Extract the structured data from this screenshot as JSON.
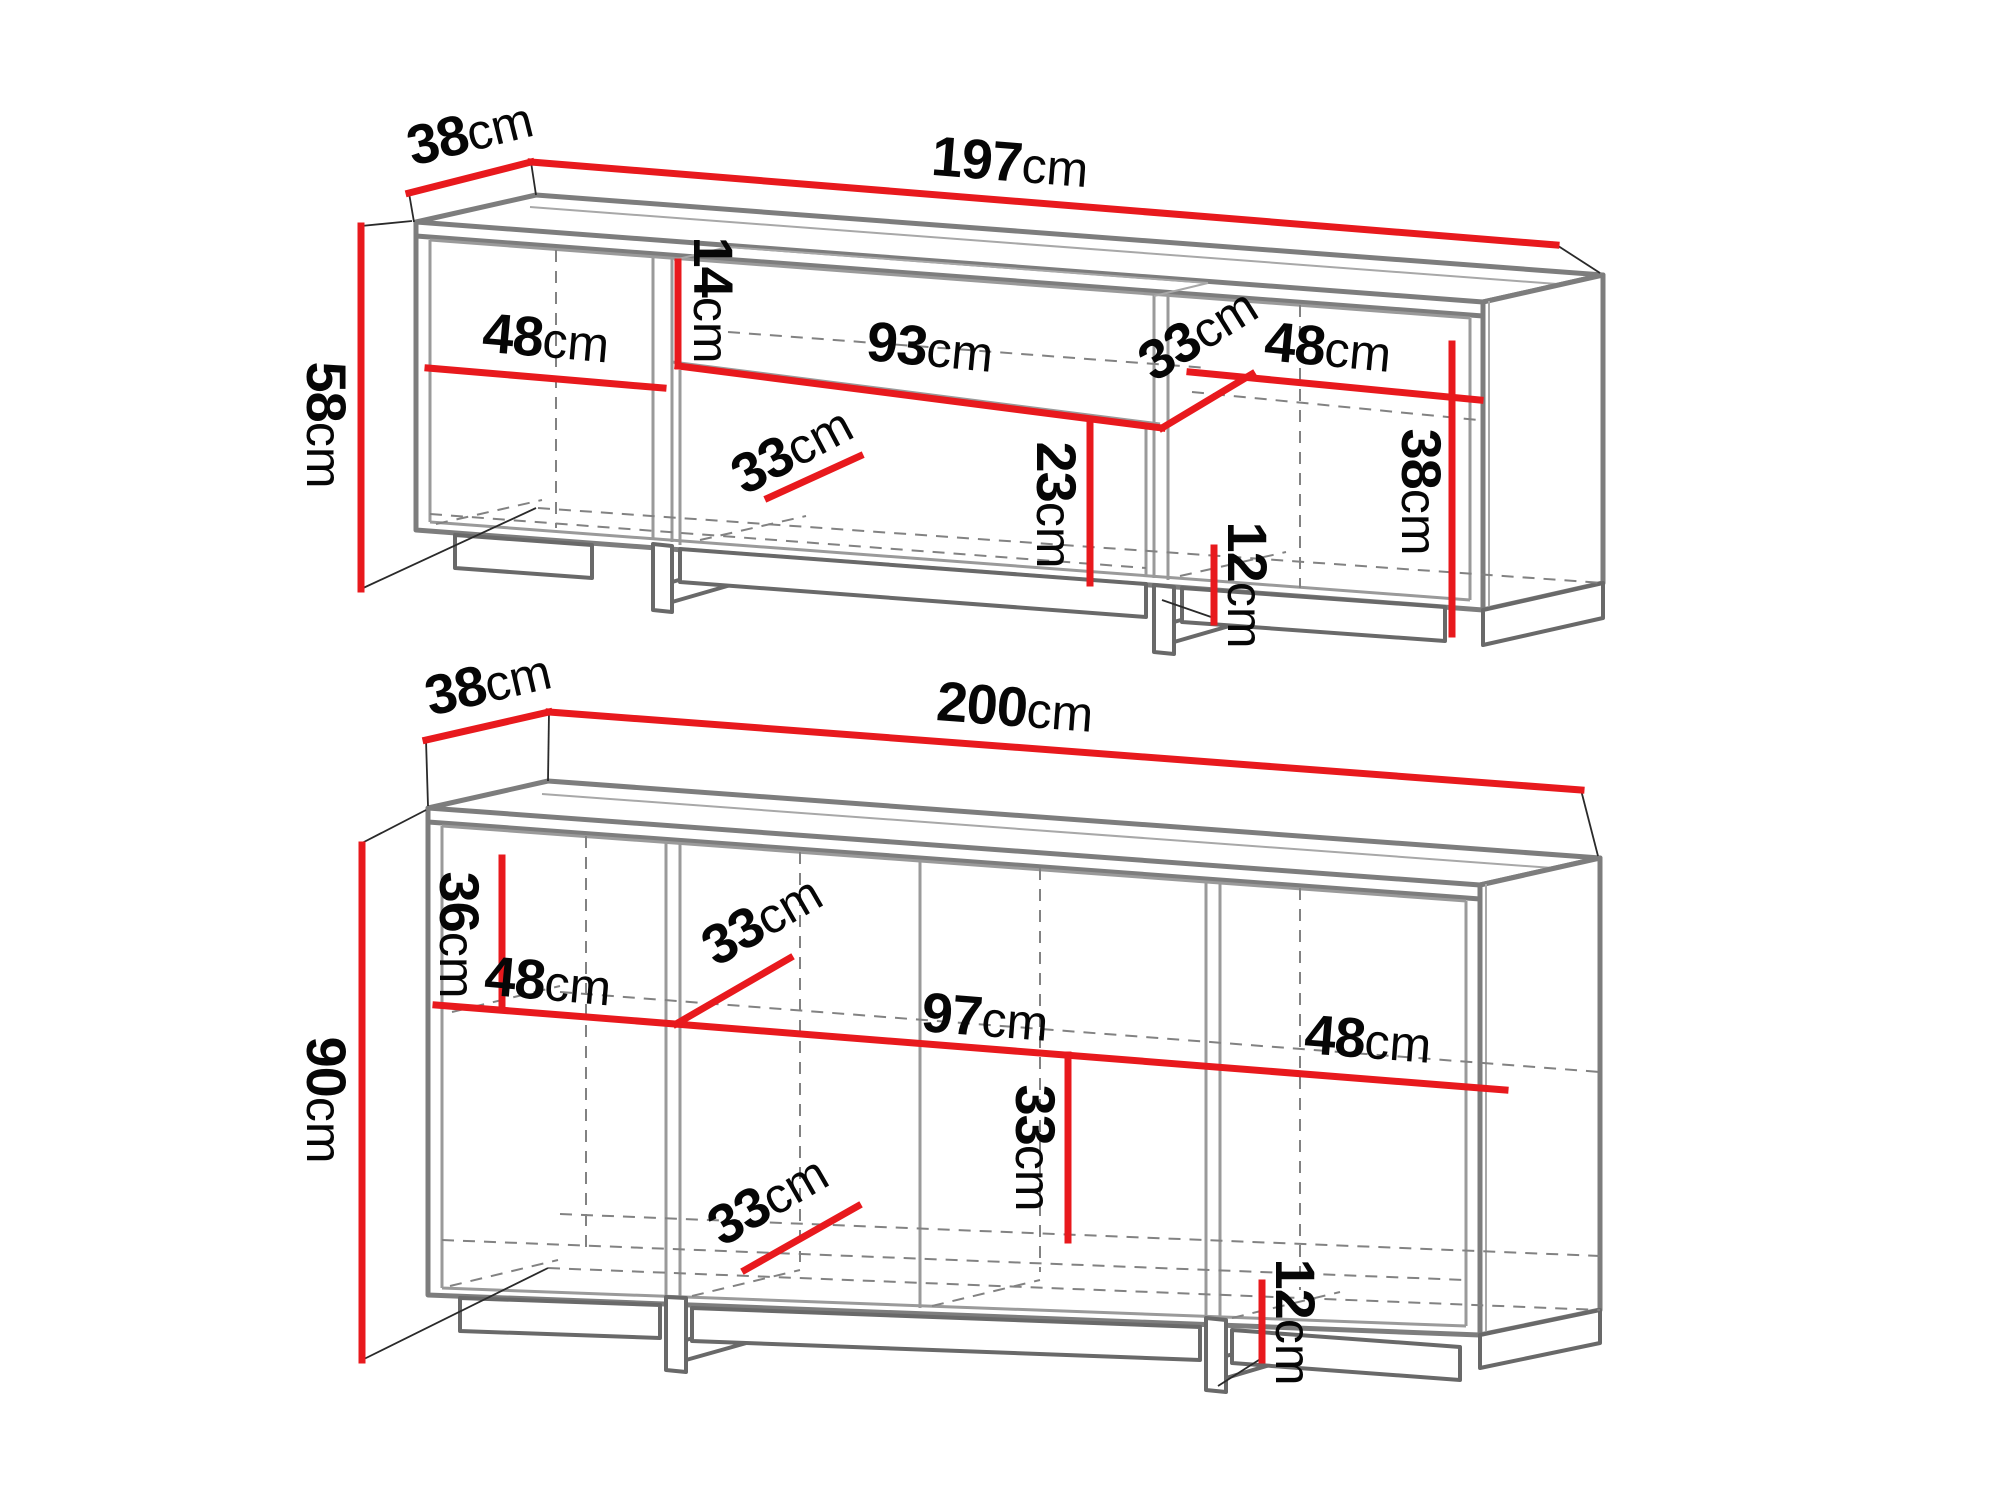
{
  "page": {
    "background": "#ffffff",
    "type": "furniture dimension diagram"
  },
  "colors": {
    "dimension_line": "#e8191d",
    "furniture_outline": "#7d7d7d",
    "hidden_edge": "#828282",
    "label_text": "#060606"
  },
  "diagrams": {
    "tv_stand": {
      "dims": {
        "depth": {
          "value": "38",
          "unit": "cm"
        },
        "width": {
          "value": "197",
          "unit": "cm"
        },
        "height": {
          "value": "58",
          "unit": "cm"
        },
        "left_compartment_width": {
          "value": "48",
          "unit": "cm"
        },
        "niche_height": {
          "value": "14",
          "unit": "cm"
        },
        "niche_width": {
          "value": "93",
          "unit": "cm"
        },
        "niche_shelf_depth": {
          "value": "33",
          "unit": "cm"
        },
        "right_compartment_width": {
          "value": "48",
          "unit": "cm"
        },
        "right_compartment_height": {
          "value": "38",
          "unit": "cm"
        },
        "middle_compartment_height": {
          "value": "23",
          "unit": "cm"
        },
        "bottom_shelf_depth": {
          "value": "33",
          "unit": "cm"
        },
        "plinth_height": {
          "value": "12",
          "unit": "cm"
        }
      }
    },
    "sideboard": {
      "dims": {
        "depth": {
          "value": "38",
          "unit": "cm"
        },
        "width": {
          "value": "200",
          "unit": "cm"
        },
        "height": {
          "value": "90",
          "unit": "cm"
        },
        "top_section_height": {
          "value": "36",
          "unit": "cm"
        },
        "left_compartment_width": {
          "value": "48",
          "unit": "cm"
        },
        "shelf_depth": {
          "value": "33",
          "unit": "cm"
        },
        "middle_section_width": {
          "value": "97",
          "unit": "cm"
        },
        "right_compartment_width": {
          "value": "48",
          "unit": "cm"
        },
        "lower_shelf_depth": {
          "value": "33",
          "unit": "cm"
        },
        "lower_section_height": {
          "value": "33",
          "unit": "cm"
        },
        "plinth_height": {
          "value": "12",
          "unit": "cm"
        }
      }
    }
  }
}
